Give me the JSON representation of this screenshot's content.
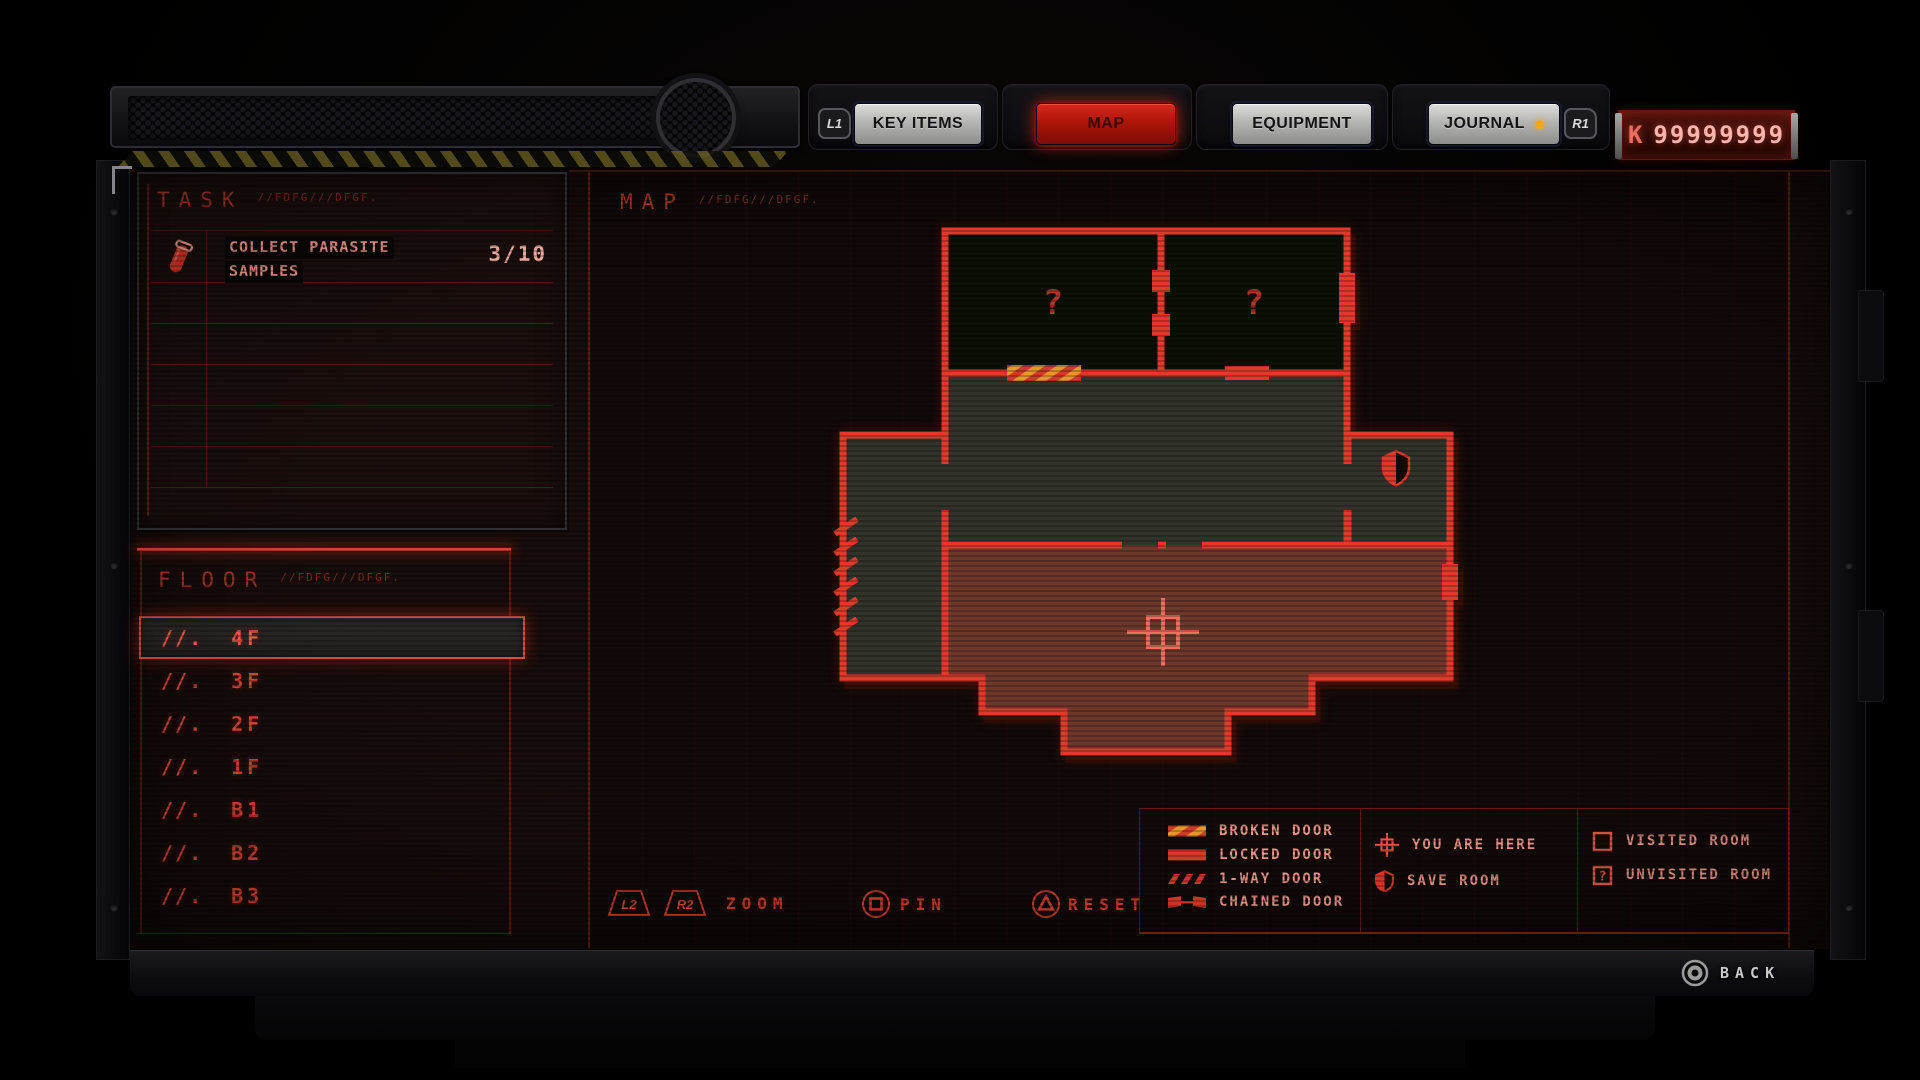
{
  "top_bar": {
    "shoulder_left": "L1",
    "shoulder_right": "R1",
    "tabs": [
      {
        "label": "KEY ITEMS",
        "active": false
      },
      {
        "label": "MAP",
        "active": true
      },
      {
        "label": "EQUIPMENT",
        "active": false
      },
      {
        "label": "JOURNAL",
        "active": false,
        "notification": true
      }
    ],
    "currency": {
      "symbol": "K",
      "amount": "99999999"
    }
  },
  "task_panel": {
    "title": "TASK",
    "annotation": "//FDFG///DFGF.",
    "tasks": [
      {
        "icon": "specimen-vial-icon",
        "line1": "COLLECT PARASITE",
        "line2": "SAMPLES",
        "progress": "3/10"
      }
    ]
  },
  "floor_panel": {
    "title": "FLOOR",
    "annotation": "//FDFG///DFGF.",
    "floors": [
      {
        "prefix": "//.",
        "label": "4F",
        "selected": true
      },
      {
        "prefix": "//.",
        "label": "3F",
        "selected": false
      },
      {
        "prefix": "//.",
        "label": "2F",
        "selected": false
      },
      {
        "prefix": "//.",
        "label": "1F",
        "selected": false
      },
      {
        "prefix": "//.",
        "label": "B1",
        "selected": false
      },
      {
        "prefix": "//.",
        "label": "B2",
        "selected": false
      },
      {
        "prefix": "//.",
        "label": "B3",
        "selected": false
      }
    ]
  },
  "map_panel": {
    "title": "MAP",
    "annotation": "//FDFG///DFGF.",
    "unknown_room_symbol": "?",
    "rooms": [
      {
        "name": "top-left-room",
        "state": "unvisited"
      },
      {
        "name": "top-right-room",
        "state": "unvisited"
      },
      {
        "name": "central-hall",
        "state": "visited"
      },
      {
        "name": "west-room",
        "state": "visited"
      },
      {
        "name": "save-room",
        "state": "visited",
        "marker": "save"
      },
      {
        "name": "south-hall",
        "state": "current",
        "marker": "player"
      }
    ],
    "door_markers": [
      "broken",
      "locked",
      "one-way",
      "chained"
    ]
  },
  "legend": {
    "doors": [
      {
        "icon": "broken-door-icon",
        "label": "BROKEN DOOR"
      },
      {
        "icon": "locked-door-icon",
        "label": "LOCKED DOOR"
      },
      {
        "icon": "one-way-door-icon",
        "label": "1-WAY DOOR"
      },
      {
        "icon": "chained-door-icon",
        "label": "CHAINED DOOR"
      }
    ],
    "markers": [
      {
        "icon": "you-are-here-icon",
        "label": "YOU ARE HERE"
      },
      {
        "icon": "save-room-icon",
        "label": "SAVE ROOM"
      }
    ],
    "rooms": [
      {
        "icon": "visited-room-icon",
        "label": "VISITED ROOM"
      },
      {
        "icon": "unvisited-room-icon",
        "label": "UNVISITED ROOM"
      }
    ]
  },
  "controls": {
    "zoom": {
      "button_left": "L2",
      "button_right": "R2",
      "label": "ZOOM"
    },
    "pin": {
      "label": "PIN"
    },
    "reset": {
      "label": "RESET"
    },
    "back": {
      "label": "BACK"
    }
  },
  "colors": {
    "wall_red": "#e23a2a",
    "current_room": "#6e372c",
    "visited_room": "#31332a",
    "unvisited_room": "#0a1006",
    "accent_text": "#ef978c",
    "notification_dot": "#f4a51e",
    "broken_door_orange": "#e8962c"
  }
}
